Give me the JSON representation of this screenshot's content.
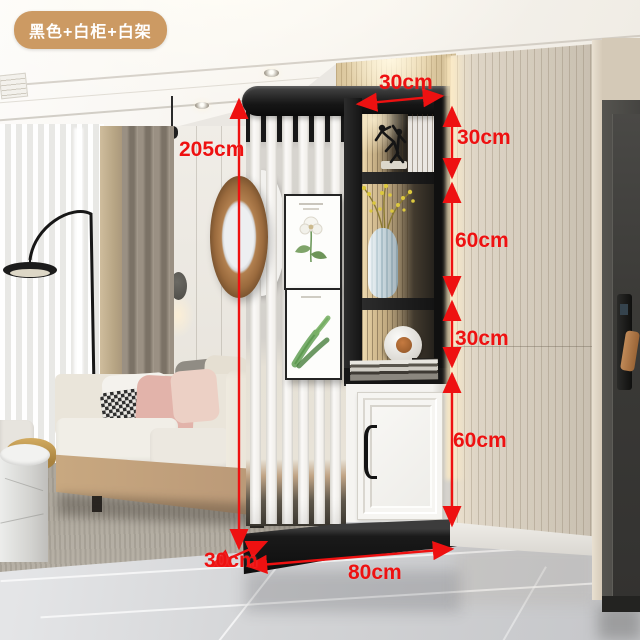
{
  "badge": {
    "label": "黑色+白柜+白架"
  },
  "dimensions": {
    "total_height": "205cm",
    "shelf_depth_top": "30cm",
    "right_sections": [
      "30cm",
      "60cm",
      "30cm",
      "60cm"
    ],
    "base_depth": "30cm",
    "total_width": "80cm"
  },
  "colors": {
    "annotation_red": "#ee1111",
    "badge_background": "#cc9a63",
    "badge_text": "#ffffff",
    "unit_black": "#1a1a1a",
    "cabinet_white": "#f5f4f1",
    "wood_wall": "#d6cec1"
  }
}
